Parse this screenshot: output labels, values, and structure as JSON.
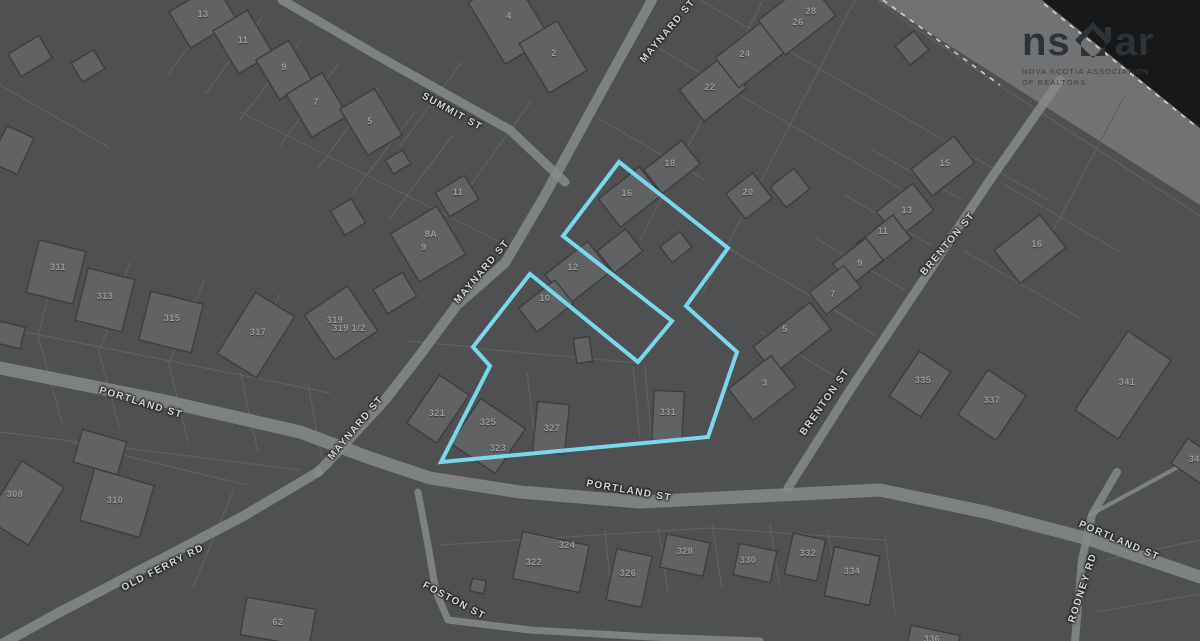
{
  "map": {
    "colors": {
      "land": "#4e5052",
      "water": "#17181a",
      "shore_band": "#707274",
      "road": "#87898b",
      "parcel_line": "#5e6062",
      "building_fill": "#606264",
      "building_stroke": "#3c3e40",
      "street_text": "#d4d5d6",
      "number_text": "#9a9c9e",
      "highlight": "#7ad7ec",
      "boundary_dash": "#dcdcdc",
      "watermark_text": "#2f3335"
    },
    "watermark": {
      "brand_prefix": "ns",
      "brand_suffix": "ar",
      "tagline_line1": "NOVA SCOTIA ASSOCIATION",
      "tagline_line2": "OF REALTORS"
    },
    "streets": [
      {
        "name": "SUMMIT ST",
        "x": 452,
        "y": 112,
        "rot": 29
      },
      {
        "name": "MAYNARD ST",
        "x": 668,
        "y": 31,
        "rot": -50
      },
      {
        "name": "MAYNARD ST",
        "x": 482,
        "y": 272,
        "rot": -50
      },
      {
        "name": "MAYNARD ST",
        "x": 356,
        "y": 428,
        "rot": -50
      },
      {
        "name": "BRENTON ST",
        "x": 948,
        "y": 244,
        "rot": -50
      },
      {
        "name": "BRENTON ST",
        "x": 825,
        "y": 402,
        "rot": -55
      },
      {
        "name": "PORTLAND ST",
        "x": 141,
        "y": 403,
        "rot": 17
      },
      {
        "name": "PORTLAND ST",
        "x": 629,
        "y": 491,
        "rot": 10
      },
      {
        "name": "PORTLAND ST",
        "x": 1119,
        "y": 541,
        "rot": 23
      },
      {
        "name": "OLD FERRY RD",
        "x": 163,
        "y": 568,
        "rot": -27
      },
      {
        "name": "FOSTON ST",
        "x": 454,
        "y": 601,
        "rot": 28
      },
      {
        "name": "RODNEY RD",
        "x": 1083,
        "y": 588,
        "rot": -72
      }
    ],
    "house_numbers": [
      {
        "n": "13",
        "x": 203,
        "y": 14
      },
      {
        "n": "11",
        "x": 243,
        "y": 40
      },
      {
        "n": "9",
        "x": 284,
        "y": 67
      },
      {
        "n": "7",
        "x": 316,
        "y": 102
      },
      {
        "n": "5",
        "x": 370,
        "y": 121
      },
      {
        "n": "4",
        "x": 509,
        "y": 16
      },
      {
        "n": "2",
        "x": 554,
        "y": 53
      },
      {
        "n": "11",
        "x": 458,
        "y": 192
      },
      {
        "n": "8A",
        "x": 431,
        "y": 234
      },
      {
        "n": "9",
        "x": 424,
        "y": 247
      },
      {
        "n": "311",
        "x": 58,
        "y": 267
      },
      {
        "n": "313",
        "x": 105,
        "y": 296
      },
      {
        "n": "315",
        "x": 172,
        "y": 318
      },
      {
        "n": "317",
        "x": 258,
        "y": 332
      },
      {
        "n": "319",
        "x": 335,
        "y": 320
      },
      {
        "n": "319 1/2",
        "x": 349,
        "y": 328
      },
      {
        "n": "18",
        "x": 670,
        "y": 163
      },
      {
        "n": "16",
        "x": 627,
        "y": 193
      },
      {
        "n": "12",
        "x": 573,
        "y": 267
      },
      {
        "n": "10",
        "x": 545,
        "y": 298
      },
      {
        "n": "20",
        "x": 748,
        "y": 192
      },
      {
        "n": "22",
        "x": 710,
        "y": 87
      },
      {
        "n": "24",
        "x": 745,
        "y": 54
      },
      {
        "n": "26",
        "x": 798,
        "y": 22
      },
      {
        "n": "28",
        "x": 811,
        "y": 11
      },
      {
        "n": "15",
        "x": 945,
        "y": 163
      },
      {
        "n": "13",
        "x": 907,
        "y": 210
      },
      {
        "n": "11",
        "x": 883,
        "y": 231
      },
      {
        "n": "9",
        "x": 860,
        "y": 263
      },
      {
        "n": "7",
        "x": 833,
        "y": 294
      },
      {
        "n": "5",
        "x": 785,
        "y": 329
      },
      {
        "n": "3",
        "x": 765,
        "y": 383
      },
      {
        "n": "16",
        "x": 1037,
        "y": 244
      },
      {
        "n": "335",
        "x": 923,
        "y": 380
      },
      {
        "n": "337",
        "x": 992,
        "y": 400
      },
      {
        "n": "341",
        "x": 1127,
        "y": 382
      },
      {
        "n": "343",
        "x": 1197,
        "y": 459
      },
      {
        "n": "308",
        "x": 15,
        "y": 494
      },
      {
        "n": "310",
        "x": 115,
        "y": 500
      },
      {
        "n": "62",
        "x": 278,
        "y": 622
      },
      {
        "n": "322",
        "x": 534,
        "y": 562
      },
      {
        "n": "324",
        "x": 567,
        "y": 545
      },
      {
        "n": "326",
        "x": 628,
        "y": 573
      },
      {
        "n": "328",
        "x": 685,
        "y": 551
      },
      {
        "n": "330",
        "x": 748,
        "y": 560
      },
      {
        "n": "332",
        "x": 808,
        "y": 553
      },
      {
        "n": "334",
        "x": 852,
        "y": 571
      },
      {
        "n": "336",
        "x": 932,
        "y": 639
      },
      {
        "n": "321",
        "x": 437,
        "y": 413
      },
      {
        "n": "325",
        "x": 488,
        "y": 422
      },
      {
        "n": "323",
        "x": 498,
        "y": 448
      },
      {
        "n": "327",
        "x": 552,
        "y": 428
      },
      {
        "n": "331",
        "x": 668,
        "y": 412
      }
    ],
    "highlight": {
      "stroke_width": 4,
      "points": [
        [
          619,
          162
        ],
        [
          728,
          248
        ],
        [
          686,
          306
        ],
        [
          737,
          352
        ],
        [
          708,
          437
        ],
        [
          441,
          462
        ],
        [
          490,
          366
        ],
        [
          473,
          347
        ],
        [
          530,
          274
        ],
        [
          638,
          362
        ],
        [
          672,
          321
        ],
        [
          563,
          236
        ]
      ]
    }
  }
}
